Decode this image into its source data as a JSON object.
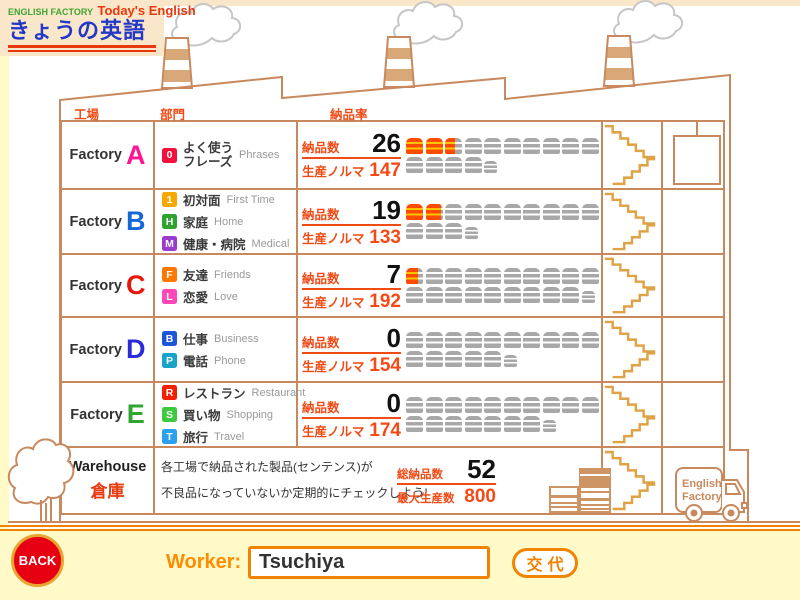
{
  "logo": {
    "brand": "ENGLISH FACTORY",
    "product": "Today's English",
    "title_jp": "きょうの英語"
  },
  "colors": {
    "accent_red_orange": "#F04A15",
    "line_tan": "#C8895E",
    "stairs_gold": "#DFA245",
    "footer_bg": "#FFFAC8",
    "panel_bg": "#FAE6C8",
    "truck_orange": "#FF4B00",
    "truck_gray": "#A8A8A8"
  },
  "headers": {
    "factory": "工場",
    "department": "部門",
    "delivery_rate": "納品率"
  },
  "labels": {
    "delivered": "納品数",
    "quota": "生産ノルマ",
    "total_delivered": "総納品数",
    "max_production": "最大生産数"
  },
  "table": {
    "factories": [
      {
        "name": "Factory",
        "letter": "A",
        "letter_color": "#FF1493",
        "categories": [
          {
            "badge": "0",
            "color": "#F3123C",
            "jp_lines": [
              "よく使う",
              "フレーズ"
            ],
            "en": "Phrases"
          }
        ],
        "delivered": 26,
        "quota": 147,
        "bar": {
          "row1_orange": 2,
          "row1_partial": 0.6,
          "row1_gray": 7,
          "row2_gray": 4,
          "row2_small": 0.7
        }
      },
      {
        "name": "Factory",
        "letter": "B",
        "letter_color": "#1668D8",
        "categories": [
          {
            "badge": "1",
            "color": "#F5A800",
            "jp_lines": [
              "初対面"
            ],
            "en": "First Time"
          },
          {
            "badge": "H",
            "color": "#2FA32F",
            "jp_lines": [
              "家庭"
            ],
            "en": "Home"
          },
          {
            "badge": "M",
            "color": "#9A3BD0",
            "jp_lines": [
              "健康・病院"
            ],
            "en": "Medical"
          }
        ],
        "delivered": 19,
        "quota": 133,
        "bar": {
          "row1_orange": 1,
          "row1_partial": 0.9,
          "row1_gray": 8,
          "row2_gray": 3,
          "row2_small": 0.3
        }
      },
      {
        "name": "Factory",
        "letter": "C",
        "letter_color": "#E8170B",
        "categories": [
          {
            "badge": "F",
            "color": "#FF7700",
            "jp_lines": [
              "友達"
            ],
            "en": "Friends"
          },
          {
            "badge": "L",
            "color": "#FF47B7",
            "jp_lines": [
              "恋愛"
            ],
            "en": "Love"
          }
        ],
        "delivered": 7,
        "quota": 192,
        "bar": {
          "row1_orange": 0,
          "row1_partial": 0.7,
          "row1_gray": 9,
          "row2_gray": 9,
          "row2_small": 0.2
        }
      },
      {
        "name": "Factory",
        "letter": "D",
        "letter_color": "#2B2BD9",
        "categories": [
          {
            "badge": "B",
            "color": "#1C55D8",
            "jp_lines": [
              "仕事"
            ],
            "en": "Business"
          },
          {
            "badge": "P",
            "color": "#18A4C8",
            "jp_lines": [
              "電話"
            ],
            "en": "Phone"
          }
        ],
        "delivered": 0,
        "quota": 154,
        "bar": {
          "row1_orange": 0,
          "row1_partial": 0,
          "row1_gray": 10,
          "row2_gray": 5,
          "row2_small": 0.4
        }
      },
      {
        "name": "Factory",
        "letter": "E",
        "letter_color": "#2FA62F",
        "categories": [
          {
            "badge": "R",
            "color": "#F22000",
            "jp_lines": [
              "レストラン"
            ],
            "en": "Restaurant"
          },
          {
            "badge": "S",
            "color": "#3DC93D",
            "jp_lines": [
              "買い物"
            ],
            "en": "Shopping"
          },
          {
            "badge": "T",
            "color": "#29A0F0",
            "jp_lines": [
              "旅行"
            ],
            "en": "Travel"
          }
        ],
        "delivered": 0,
        "quota": 174,
        "bar": {
          "row1_orange": 0,
          "row1_partial": 0,
          "row1_gray": 10,
          "row2_gray": 7,
          "row2_small": 0.4
        }
      }
    ]
  },
  "warehouse": {
    "name": "Warehouse",
    "name_jp": "倉庫",
    "desc_line1": "各工場で納品された製品(センテンス)が",
    "desc_line2": "不良品になっていないか定期的にチェックしよう!",
    "total_delivered": 52,
    "max_production": 800
  },
  "truck_label": {
    "line1": "English",
    "line2": "Factory"
  },
  "footer": {
    "back": "BACK",
    "worker_label": "Worker:",
    "worker_value": "Tsuchiya",
    "change": "交代"
  }
}
